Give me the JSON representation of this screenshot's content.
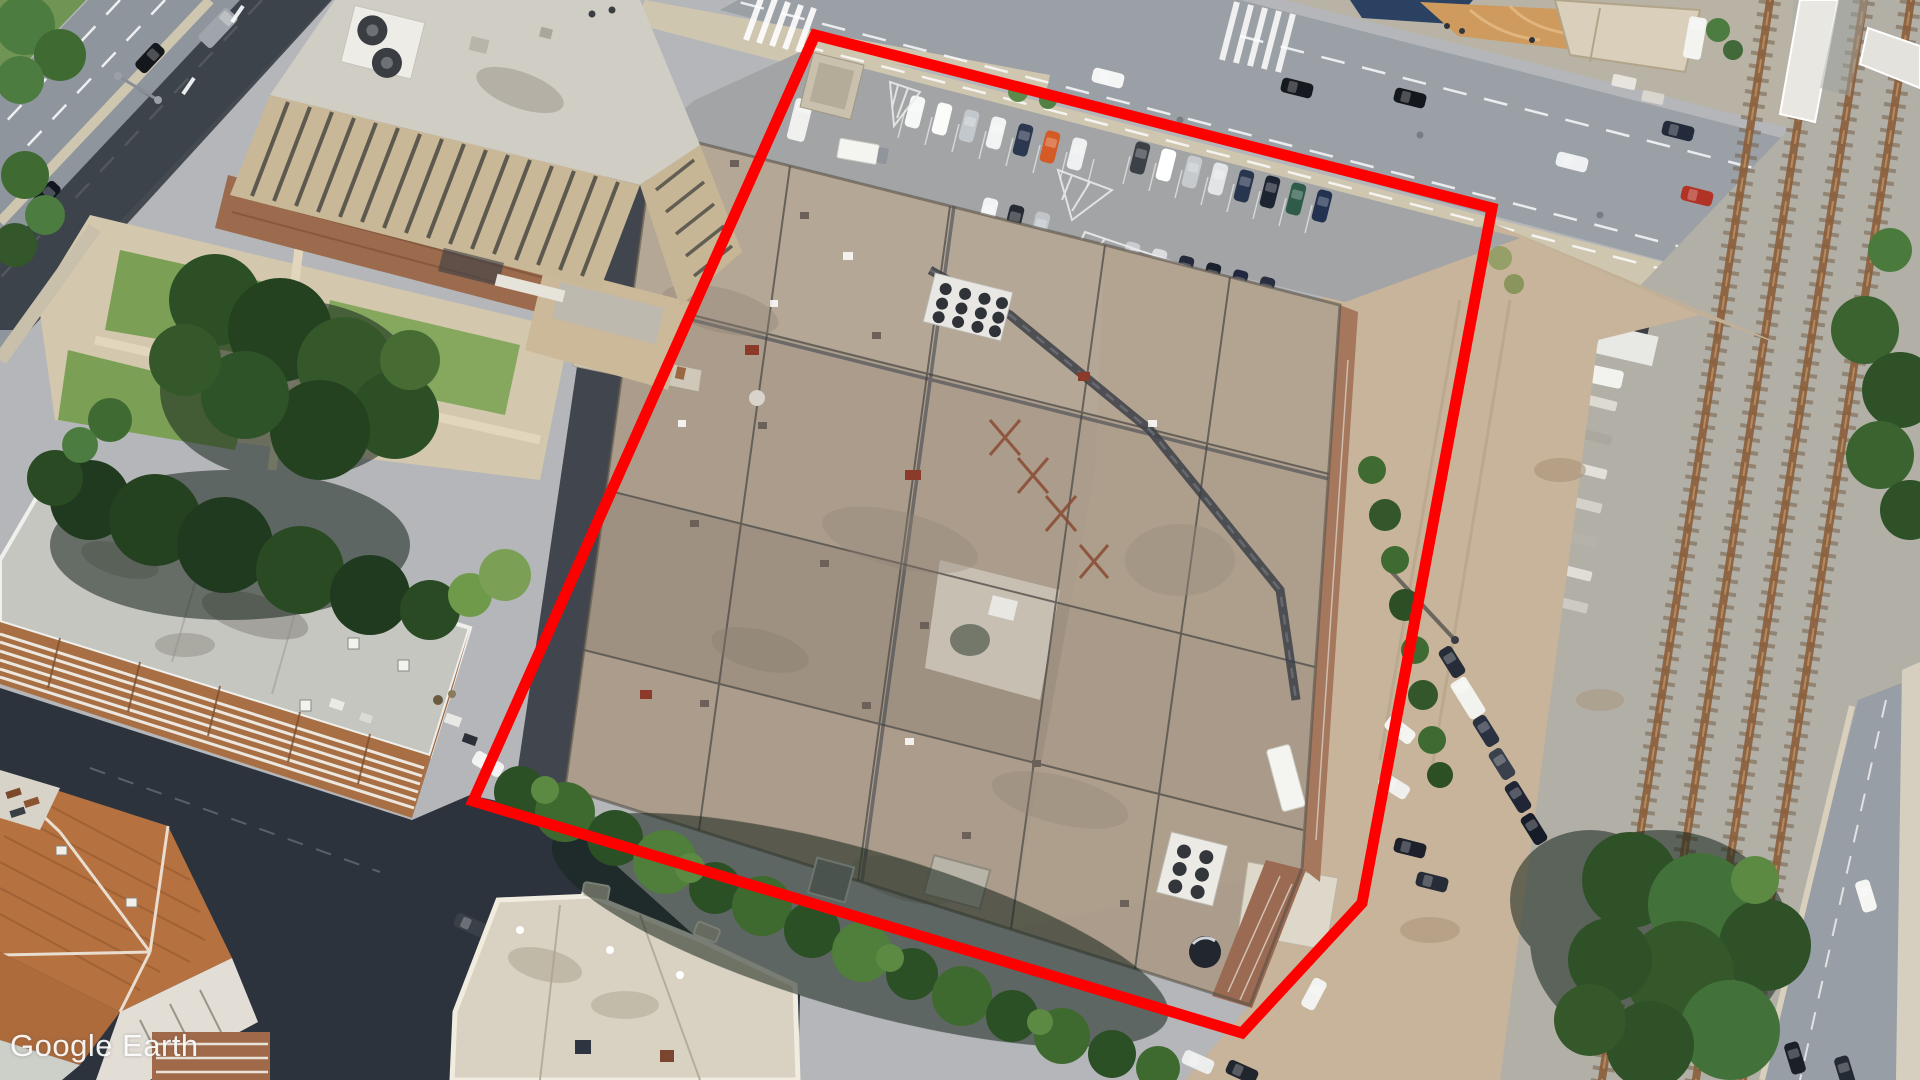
{
  "watermark": {
    "text": "Google Earth"
  },
  "overlay": {
    "label": "property-outline",
    "color": "#ff0000",
    "stroke_width": 11,
    "points": "815,35 1492,208 1362,903 1242,1033 473,801"
  },
  "scene": {
    "type": "aerial-satellite-imagery",
    "description": "Oblique aerial view of an urban block: a large flat-roofed industrial building outlined in red, surface parking with cars to the north, dirt staging yard and four-track railway corridor to the east, office tower with plaza to the northwest, apartment buildings with a terracotta tile roof to the southwest.",
    "areas": [
      "multi-lane boulevard (top left)",
      "office tower with rooftop fans",
      "plaza with lawns and paths",
      "surface parking lot with striped stalls",
      "industrial building complex (red outline)",
      "dirt staging area with angled parked cars",
      "railway corridor with rusty tracks",
      "rail overpass (top right)",
      "apartment slab with balconies",
      "terracotta tiled roof building",
      "cream flat-roof building (bottom center)"
    ],
    "rail_tracks_count": 4,
    "parked_car_rows": {
      "row_a": 7,
      "row_b": 8,
      "row_c": 6,
      "row_d": 3,
      "dirt_row": 6
    },
    "palette": {
      "asphalt": "#9aa0a6",
      "sidewalk": "#cfc6b0",
      "roof_tan": "#ab9c8b",
      "dirt": "#c7b49a",
      "ballast": "#b2afa7",
      "tree_green": "#2c5026",
      "outline_red": "#ff0000"
    }
  }
}
